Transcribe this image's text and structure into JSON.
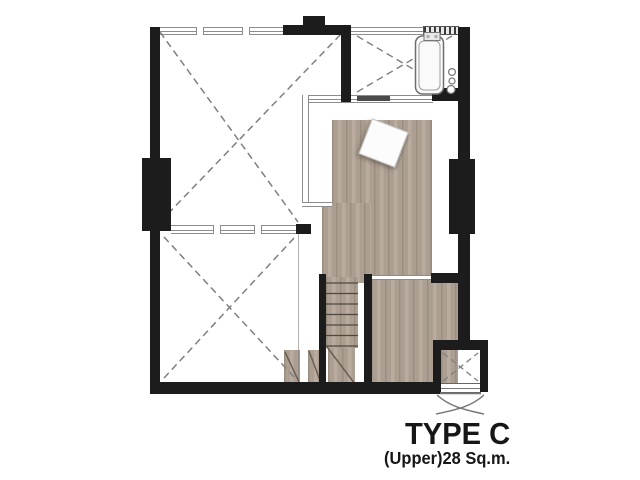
{
  "plan": {
    "title": "TYPE C",
    "subtitle": "(Upper)28 Sq.m."
  },
  "stairs": {
    "tread_count": 7
  },
  "symbols": {
    "void_cross": "dashed-x",
    "bathtub": "bathtub-outline",
    "staircase": "treads-with-break-line",
    "ac_ledge": "crossed-square-with-louver",
    "table": "tilted-square",
    "condensing_unit": "curved-crossed-legs"
  },
  "colors": {
    "bg": "#ffffff",
    "wall": "#1c1c1c",
    "wood": "#ac9f92",
    "woodDark": "#9a8e81",
    "woodLight": "#b9ac9f",
    "line": "#8c8c8c",
    "dash": "#7f7f7f",
    "tread": "#4f4840",
    "doorBar": "#4a4a4a",
    "fixture": "#6f6f6f",
    "text": "#161616"
  }
}
